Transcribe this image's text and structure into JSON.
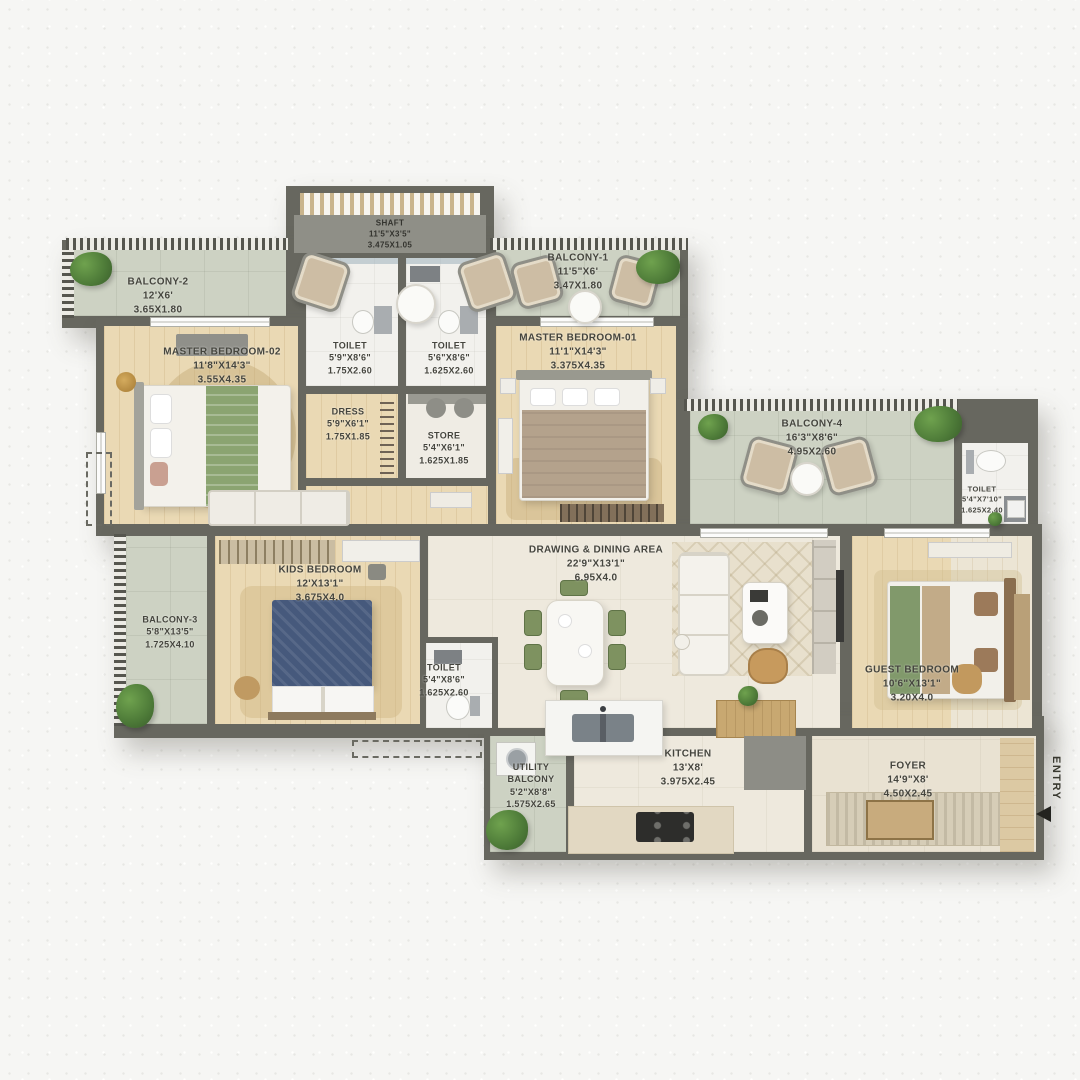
{
  "palette": {
    "wall": "#67675F",
    "balcony_floor": "#CDD2C3",
    "wood_floor": "#EAD9B4",
    "living_floor": "#EEE9DD",
    "toilet_floor": "#F2F1ED",
    "foyer_floor": "#E9E2D2",
    "label_text": "#45453E",
    "plant_green": "#4E7A3A",
    "bed_green": "#8BA471",
    "kids_bed_blue": "#46597C"
  },
  "rooms": {
    "shaft": {
      "name": "SHAFT",
      "ft": "11'5\"X3'5\"",
      "m": "3.475X1.05"
    },
    "balcony2": {
      "name": "BALCONY-2",
      "ft": "12'X6'",
      "m": "3.65X1.80"
    },
    "mb02": {
      "name": "MASTER BEDROOM-02",
      "ft": "11'8\"X14'3\"",
      "m": "3.55X4.35"
    },
    "toilet_mb02": {
      "name": "TOILET",
      "ft": "5'9\"X8'6\"",
      "m": "1.75X2.60"
    },
    "toilet_mb01": {
      "name": "TOILET",
      "ft": "5'6\"X8'6\"",
      "m": "1.625X2.60"
    },
    "dress": {
      "name": "DRESS",
      "ft": "5'9\"X6'1\"",
      "m": "1.75X1.85"
    },
    "store": {
      "name": "STORE",
      "ft": "5'4\"X6'1\"",
      "m": "1.625X1.85"
    },
    "balcony1": {
      "name": "BALCONY-1",
      "ft": "11'5\"X6'",
      "m": "3.47X1.80"
    },
    "mb01": {
      "name": "MASTER BEDROOM-01",
      "ft": "11'1\"X14'3\"",
      "m": "3.375X4.35"
    },
    "balcony4": {
      "name": "BALCONY-4",
      "ft": "16'3\"X8'6\"",
      "m": "4.95X2.60"
    },
    "toilet_right": {
      "name": "TOILET",
      "ft": "5'4\"X7'10\"",
      "m": "1.625X2.40"
    },
    "balcony3": {
      "name": "BALCONY-3",
      "ft": "5'8\"X13'5\"",
      "m": "1.725X4.10"
    },
    "kids": {
      "name": "KIDS BEDROOM",
      "ft": "12'X13'1\"",
      "m": "3.675X4.0"
    },
    "drawing": {
      "name": "DRAWING & DINING AREA",
      "ft": "22'9\"X13'1\"",
      "m": "6.95X4.0"
    },
    "toilet_common": {
      "name": "TOILET",
      "ft": "5'4\"X8'6\"",
      "m": "1.625X2.60"
    },
    "guest": {
      "name": "GUEST BEDROOM",
      "ft": "10'6\"X13'1\"",
      "m": "3.20X4.0"
    },
    "utility": {
      "name": "UTILITY BALCONY",
      "ft": "5'2\"X8'8\"",
      "m": "1.575X2.65"
    },
    "kitchen": {
      "name": "KITCHEN",
      "ft": "13'X8'",
      "m": "3.975X2.45"
    },
    "foyer": {
      "name": "FOYER",
      "ft": "14'9\"X8'",
      "m": "4.50X2.45"
    }
  },
  "entry": {
    "label": "ENTRY"
  }
}
